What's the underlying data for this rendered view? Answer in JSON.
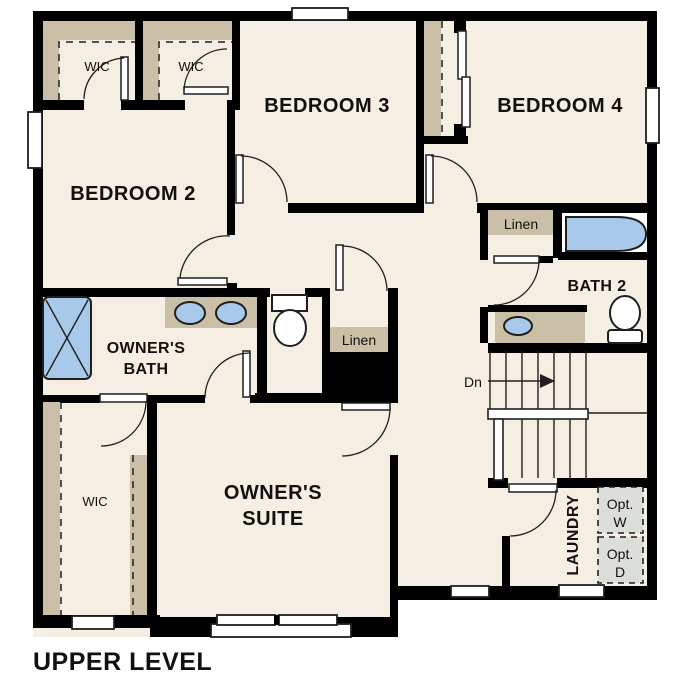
{
  "title": {
    "text": "UPPER LEVEL"
  },
  "colors": {
    "wall": "#000000",
    "floor": "#f5eee2",
    "tan": "#cbc0a7",
    "blue": "#a8c9e9",
    "outline": "#1f1f1f",
    "optbox": "#dcded9",
    "white": "#ffffff",
    "text": "#111111"
  },
  "labels": {
    "bedroom2": "BEDROOM 2",
    "bedroom3": "BEDROOM 3",
    "bedroom4": "BEDROOM 4",
    "wic_top_left": "WIC",
    "wic_top_mid": "WIC",
    "wic_owner": "WIC",
    "linen_hall": "Linen",
    "linen_bath2": "Linen",
    "bath2": "BATH 2",
    "owners_bath_line1": "OWNER'S",
    "owners_bath_line2": "BATH",
    "owners_suite_line1": "OWNER'S",
    "owners_suite_line2": "SUITE",
    "laundry": "LAUNDRY",
    "stairs_dn": "Dn",
    "opt_w_line1": "Opt.",
    "opt_w_line2": "W",
    "opt_d_line1": "Opt.",
    "opt_d_line2": "D"
  }
}
